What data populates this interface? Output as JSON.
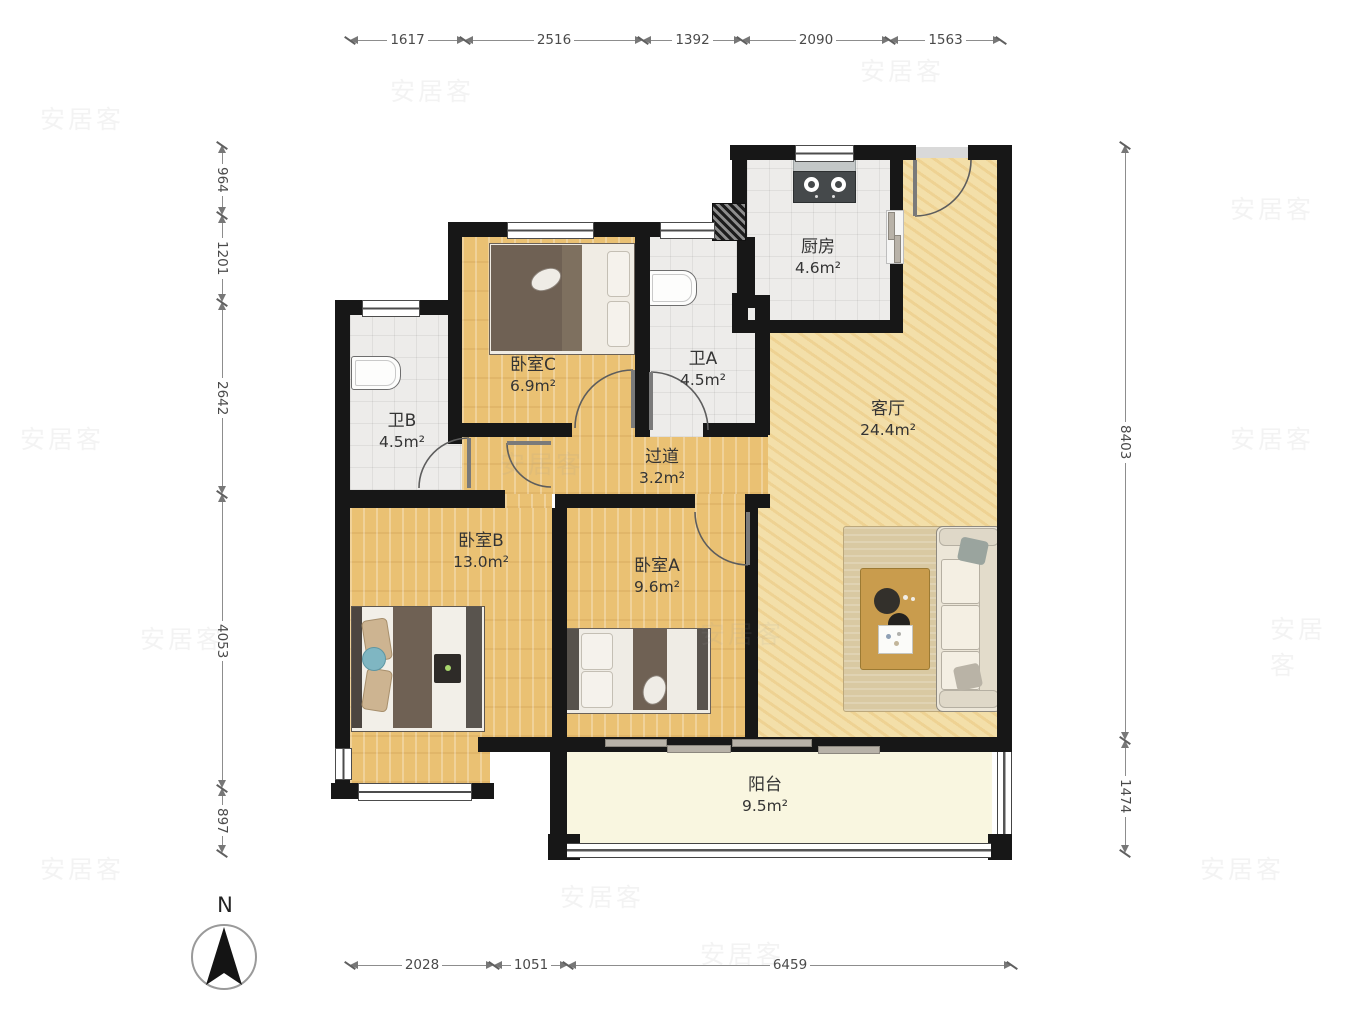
{
  "compass": {
    "label": "N"
  },
  "watermark": {
    "text": "安居客"
  },
  "dimensions": {
    "top": [
      "1617",
      "2516",
      "1392",
      "2090",
      "1563"
    ],
    "left": [
      "964",
      "1201",
      "2642",
      "4053",
      "897"
    ],
    "right": [
      "8403",
      "1474"
    ],
    "bottom": [
      "2028",
      "1051",
      "6459"
    ]
  },
  "rooms": {
    "kitchen": {
      "name": "厨房",
      "area": "4.6m²"
    },
    "bath_a": {
      "name": "卫A",
      "area": "4.5m²"
    },
    "bath_b": {
      "name": "卫B",
      "area": "4.5m²"
    },
    "bedroom_c": {
      "name": "卧室C",
      "area": "6.9m²"
    },
    "living": {
      "name": "客厅",
      "area": "24.4m²"
    },
    "hallway": {
      "name": "过道",
      "area": "3.2m²"
    },
    "bedroom_a": {
      "name": "卧室A",
      "area": "9.6m²"
    },
    "bedroom_b": {
      "name": "卧室B",
      "area": "13.0m²"
    },
    "balcony": {
      "name": "阳台",
      "area": "9.5m²"
    }
  },
  "colors": {
    "wall": "#171717",
    "wood_floor": "#eac173",
    "living_floor": "#f3dfa9",
    "tile_floor": "#edecea",
    "balcony_floor": "#f9f6e0"
  }
}
